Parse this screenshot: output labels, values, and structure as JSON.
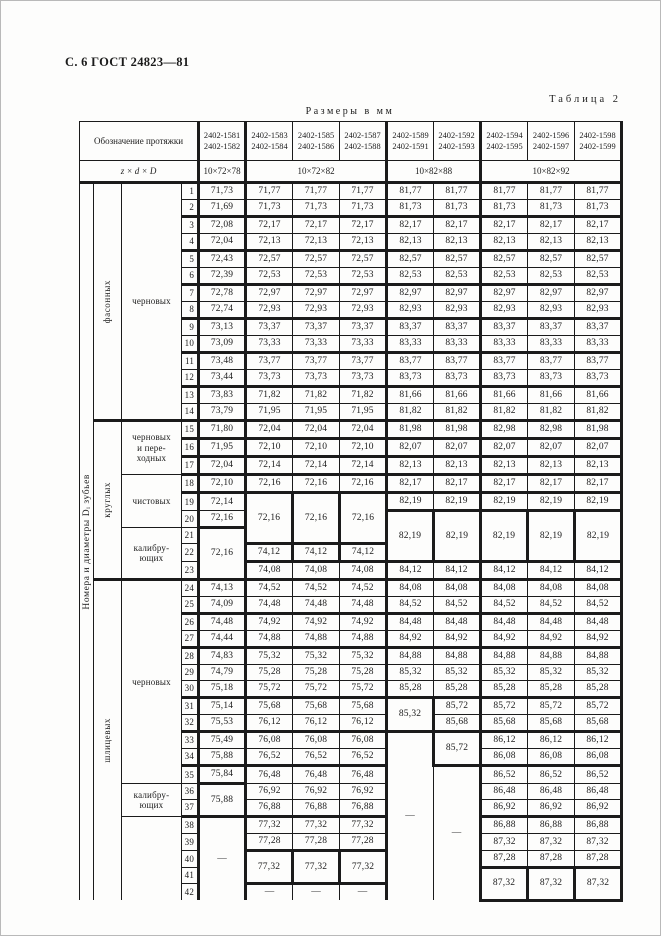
{
  "page": {
    "header_left": "С. 6 ГОСТ 24823—81",
    "table_caption": "Таблица 2",
    "units_caption": "Размеры в мм"
  },
  "colors": {
    "ink": "#1b1b1b",
    "paper": "#fdfdfc"
  },
  "table": {
    "side_label": "Номера и диаметры Dᵢ зубьев",
    "header": {
      "designation_label": "Обозначение протяжки",
      "formula_label": "z × d × D",
      "designations": [
        [
          "2402-1581",
          "2402-1582"
        ],
        [
          "2402-1583",
          "2402-1584"
        ],
        [
          "2402-1585",
          "2402-1586"
        ],
        [
          "2402-1587",
          "2402-1588"
        ],
        [
          "2402-1589",
          "2402-1591"
        ],
        [
          "2402-1592",
          "2402-1593"
        ],
        [
          "2402-1594",
          "2402-1595"
        ],
        [
          "2402-1596",
          "2402-1597"
        ],
        [
          "2402-1598",
          "2402-1599"
        ]
      ],
      "sizes": [
        {
          "label": "10×72×78",
          "span": 1
        },
        {
          "label": "10×72×82",
          "span": 3
        },
        {
          "label": "10×82×88",
          "span": 2
        },
        {
          "label": "10×82×92",
          "span": 3
        }
      ]
    },
    "groups": [
      {
        "label": "фасонных",
        "start": 1,
        "span": 14,
        "hb": true
      },
      {
        "label": "круглых",
        "start": 15,
        "span": 9,
        "hb": true
      },
      {
        "label": "шлицевых",
        "start": 24,
        "span": 19
      }
    ],
    "categories": [
      {
        "label": "черновых",
        "start": 1,
        "span": 14,
        "hb": true
      },
      {
        "label": "черновых\nи пере-\nходных",
        "start": 15,
        "span": 3
      },
      {
        "label": "чистовых",
        "start": 18,
        "span": 3
      },
      {
        "label": "калибру-\nющих",
        "start": 21,
        "span": 3,
        "hb": true
      },
      {
        "label": "черновых",
        "start": 24,
        "span": 12
      },
      {
        "label": "калибру-\nющих",
        "start": 36,
        "span": 2
      },
      {
        "label": "",
        "start": 38,
        "span": 5
      }
    ],
    "layout": {
      "col_widths": [
        14,
        28,
        60,
        17,
        47,
        47,
        47,
        47,
        47,
        47,
        47,
        47,
        47
      ]
    },
    "body": {
      "heavy_after": [
        2,
        4,
        6,
        8,
        10,
        12,
        14,
        15,
        16,
        17,
        18,
        23,
        25,
        27,
        30,
        32,
        34,
        37
      ],
      "rows": [
        [
          "71,73",
          "71,77",
          "71,77",
          "71,77",
          "81,77",
          "81,77",
          "81,77",
          "81,77",
          "81,77"
        ],
        [
          "71,69",
          "71,73",
          "71,73",
          "71,73",
          "81,73",
          "81,73",
          "81,73",
          "81,73",
          "81,73"
        ],
        [
          "72,08",
          "72,17",
          "72,17",
          "72,17",
          "82,17",
          "82,17",
          "82,17",
          "82,17",
          "82,17"
        ],
        [
          "72,04",
          "72,13",
          "72,13",
          "72,13",
          "82,13",
          "82,13",
          "82,13",
          "82,13",
          "82,13"
        ],
        [
          "72,43",
          "72,57",
          "72,57",
          "72,57",
          "82,57",
          "82,57",
          "82,57",
          "82,57",
          "82,57"
        ],
        [
          "72,39",
          "72,53",
          "72,53",
          "72,53",
          "82,53",
          "82,53",
          "82,53",
          "82,53",
          "82,53"
        ],
        [
          "72,78",
          "72,97",
          "72,97",
          "72,97",
          "82,97",
          "82,97",
          "82,97",
          "82,97",
          "82,97"
        ],
        [
          "72,74",
          "72,93",
          "72,93",
          "72,93",
          "82,93",
          "82,93",
          "82,93",
          "82,93",
          "82,93"
        ],
        [
          "73,13",
          "73,37",
          "73,37",
          "73,37",
          "83,37",
          "83,37",
          "83,37",
          "83,37",
          "83,37"
        ],
        [
          "73,09",
          "73,33",
          "73,33",
          "73,33",
          "83,33",
          "83,33",
          "83,33",
          "83,33",
          "83,33"
        ],
        [
          "73,48",
          "73,77",
          "73,77",
          "73,77",
          "83,77",
          "83,77",
          "83,77",
          "83,77",
          "83,77"
        ],
        [
          "73,44",
          "73,73",
          "73,73",
          "73,73",
          "83,73",
          "83,73",
          "83,73",
          "83,73",
          "83,73"
        ],
        [
          "73,83",
          {
            "v": "71,82",
            "ht": true
          },
          {
            "v": "71,82",
            "ht": true
          },
          {
            "v": "71,82",
            "ht": true
          },
          {
            "v": "81,66",
            "ht": true
          },
          {
            "v": "81,66",
            "ht": true
          },
          {
            "v": "81,66",
            "ht": true
          },
          {
            "v": "81,66",
            "ht": true
          },
          {
            "v": "81,66",
            "ht": true
          }
        ],
        [
          "73,79",
          "71,95",
          "71,95",
          "71,95",
          "81,82",
          "81,82",
          "81,82",
          "81,82",
          "81,82"
        ],
        [
          "71,80",
          "72,04",
          "72,04",
          "72,04",
          "81,98",
          "81,98",
          "82,98",
          "82,98",
          "81,98"
        ],
        [
          "71,95",
          "72,10",
          "72,10",
          "72,10",
          "82,07",
          "82,07",
          "82,07",
          "82,07",
          "82,07"
        ],
        [
          "72,04",
          "72,14",
          "72,14",
          "72,14",
          "82,13",
          "82,13",
          "82,13",
          "82,13",
          "82,13"
        ],
        [
          "72,10",
          "72,16",
          "72,16",
          "72,16",
          "82,17",
          "82,17",
          "82,17",
          "82,17",
          "82,17"
        ],
        [
          "72,14",
          {
            "v": "72,16",
            "rs": 3,
            "box": true
          },
          {
            "v": "72,16",
            "rs": 3,
            "box": true
          },
          {
            "v": "72,16",
            "rs": 3,
            "box": true
          },
          "82,19",
          "82,19",
          "82,19",
          "82,19",
          "82,19"
        ],
        [
          "72,16",
          null,
          null,
          null,
          {
            "v": "82,19",
            "rs": 3,
            "box": true
          },
          {
            "v": "82,19",
            "rs": 3,
            "box": true
          },
          {
            "v": "82,19",
            "rs": 3,
            "box": true
          },
          {
            "v": "82,19",
            "rs": 3,
            "box": true
          },
          {
            "v": "82,19",
            "rs": 3,
            "box": true
          }
        ],
        [
          {
            "v": "72,16",
            "rs": 3,
            "box": true
          },
          null,
          null,
          null,
          null,
          null,
          null,
          null,
          null
        ],
        [
          null,
          {
            "v": "74,12",
            "box": true
          },
          {
            "v": "74,12",
            "box": true
          },
          {
            "v": "74,12",
            "box": true
          },
          null,
          null,
          null,
          null,
          null
        ],
        [
          null,
          "74,08",
          "74,08",
          "74,08",
          "84,12",
          "84,12",
          "84,12",
          "84,12",
          "84,12"
        ],
        [
          "74,13",
          "74,52",
          "74,52",
          "74,52",
          "84,08",
          "84,08",
          "84,08",
          "84,08",
          "84,08"
        ],
        [
          "74,09",
          "74,48",
          "74,48",
          "74,48",
          "84,52",
          "84,52",
          "84,52",
          "84,52",
          "84,52"
        ],
        [
          "74,48",
          "74,92",
          "74,92",
          "74,92",
          "84,48",
          "84,48",
          "84,48",
          "84,48",
          "84,48"
        ],
        [
          "74,44",
          "74,88",
          "74,88",
          "74,88",
          "84,92",
          "84,92",
          "84,92",
          "84,92",
          "84,92"
        ],
        [
          "74,83",
          "75,32",
          "75,32",
          "75,32",
          "84,88",
          "84,88",
          "84,88",
          "84,88",
          "84,88"
        ],
        [
          "74,79",
          "75,28",
          "75,28",
          "75,28",
          "85,32",
          "85,32",
          "85,32",
          "85,32",
          "85,32"
        ],
        [
          "75,18",
          "75,72",
          "75,72",
          "75,72",
          "85,28",
          "85,28",
          "85,28",
          "85,28",
          "85,28"
        ],
        [
          "75,14",
          "75,68",
          "75,68",
          "75,68",
          {
            "v": "85,32",
            "rs": 2,
            "box": true
          },
          "85,72",
          "85,72",
          "85,72",
          "85,72"
        ],
        [
          "75,53",
          "76,12",
          "76,12",
          "76,12",
          null,
          "85,68",
          "85,68",
          "85,68",
          "85,68"
        ],
        [
          "75,49",
          "76,08",
          "76,08",
          "76,08",
          {
            "v": "—",
            "rs": 10
          },
          {
            "v": "85,72",
            "rs": 2,
            "box": true
          },
          "86,12",
          "86,12",
          "86,12"
        ],
        [
          "75,88",
          "76,52",
          "76,52",
          "76,52",
          null,
          null,
          "86,08",
          "86,08",
          "86,08"
        ],
        [
          "75,84",
          "76,48",
          "76,48",
          "76,48",
          null,
          {
            "v": "—",
            "rs": 8
          },
          "86,52",
          "86,52",
          "86,52"
        ],
        [
          {
            "v": "75,88",
            "rs": 2,
            "box": true
          },
          "76,92",
          "76,92",
          "76,92",
          null,
          null,
          "86,48",
          "86,48",
          "86,48"
        ],
        [
          null,
          "76,88",
          "76,88",
          "76,88",
          null,
          null,
          "86,92",
          "86,92",
          "86,92"
        ],
        [
          {
            "v": "—",
            "rs": 5
          },
          "77,32",
          "77,32",
          "77,32",
          null,
          null,
          "86,88",
          "86,88",
          "86,88"
        ],
        [
          null,
          "77,28",
          "77,28",
          "77,28",
          null,
          null,
          "87,32",
          "87,32",
          "87,32"
        ],
        [
          null,
          {
            "v": "77,32",
            "rs": 2,
            "box": true
          },
          {
            "v": "77,32",
            "rs": 2,
            "box": true
          },
          {
            "v": "77,32",
            "rs": 2,
            "box": true
          },
          null,
          null,
          "87,28",
          "87,28",
          "87,28"
        ],
        [
          null,
          null,
          null,
          null,
          null,
          null,
          {
            "v": "87,32",
            "rs": 2,
            "box": true
          },
          {
            "v": "87,32",
            "rs": 2,
            "box": true
          },
          {
            "v": "87,32",
            "rs": 2,
            "box": true
          }
        ],
        [
          null,
          "—",
          "—",
          "—",
          null,
          null,
          null,
          null,
          null
        ]
      ]
    }
  }
}
